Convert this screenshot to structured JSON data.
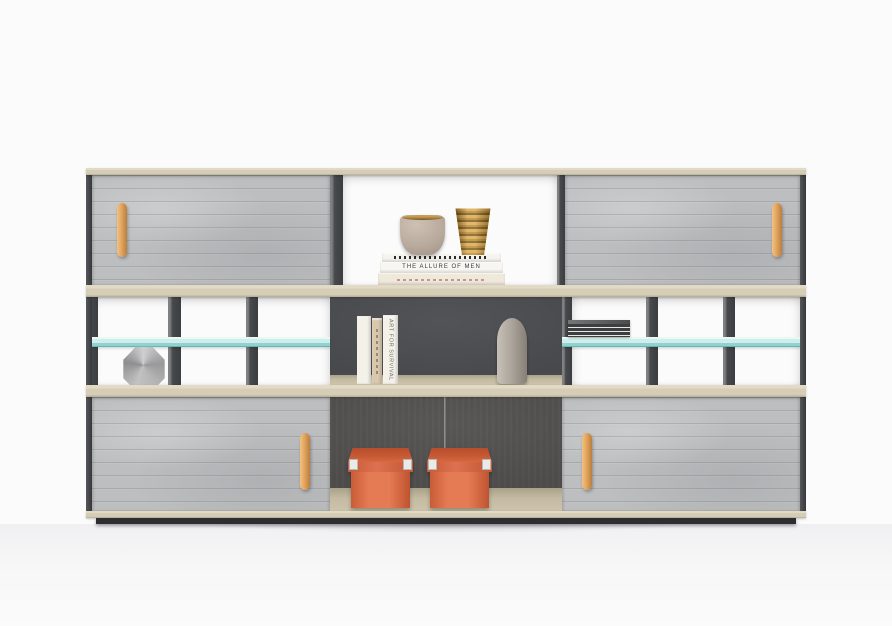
{
  "meta": {
    "image_type": "product photograph",
    "subject": "modern low office sideboard / shelving unit with grey felt sliding doors, open cubbies, teal glass shelves and decor objects",
    "background": "plain white studio backdrop"
  },
  "colors": {
    "bg": "#fbfbfb",
    "felt": "#bdbec0",
    "felt-dark": "#4e4c4b",
    "wood": "#d6cdb7",
    "wood-top": "#e2dac5",
    "wood-floor": "#ccc3ab",
    "charcoal": "#47494c",
    "plinth": "#2c2e31",
    "glass": "#cdeeea",
    "glass-edge": "#8fd2d0",
    "oak": "#e2a55f",
    "orange": "#dd7050",
    "orange-dark": "#c75a35",
    "paper": "#f4f1e9",
    "paper-tan": "#d9c8ae",
    "gold": "#b08233",
    "gold-rim": "#c79a4e",
    "taupe": "#b7a99c",
    "stone": "#aaa49b"
  },
  "cabinet": {
    "structure": "three horizontal levels framed in light oak banding with dark charcoal side panels and recessed dark plinth",
    "doors": [
      {
        "id": "top-left",
        "material": "grey felt",
        "handle_side": "left"
      },
      {
        "id": "top-right",
        "material": "grey felt",
        "handle_side": "right"
      },
      {
        "id": "bottom-left",
        "material": "grey felt",
        "handle_side": "right"
      },
      {
        "id": "bottom-right",
        "material": "grey felt",
        "handle_side": "left"
      }
    ],
    "handles": "vertical light oak bar handles",
    "shelves": [
      "teal tinted glass shelf left section",
      "teal tinted glass shelf right section"
    ]
  },
  "decor": {
    "top_shelf": {
      "book_stack": [
        {
          "spine": "black-and-white patterned spine"
        },
        {
          "spine": "white spine with printed title",
          "title": "THE ALLURE OF MEN"
        },
        {
          "spine": "cream spine with small red lettering"
        }
      ],
      "vases": [
        {
          "name": "taupe ceramic vase with gold rim"
        },
        {
          "name": "amber gold ribbed glass vase"
        }
      ]
    },
    "middle_shelf": {
      "standing_books": [
        {
          "spine": "white book"
        },
        {
          "spine": "tan book with vertical lettering"
        },
        {
          "spine": "white book with vertical title",
          "title": "ART FOR SURVIVAL"
        }
      ],
      "vase": {
        "name": "tall grey stone bottle vase"
      },
      "ornament": {
        "name": "grey faceted geodesic sphere"
      },
      "magazines": {
        "name": "stack of dark magazines on glass shelf"
      }
    },
    "bottom_shelf": {
      "boxes": [
        {
          "name": "orange storage box with white metal corner clips"
        },
        {
          "name": "orange storage box with white metal corner clips"
        }
      ],
      "back": "dark felt back panel with vertical seam"
    }
  },
  "text": {
    "book_title_top": "THE ALLURE OF MEN",
    "book_title_middle": "ART FOR SURVIVAL"
  }
}
